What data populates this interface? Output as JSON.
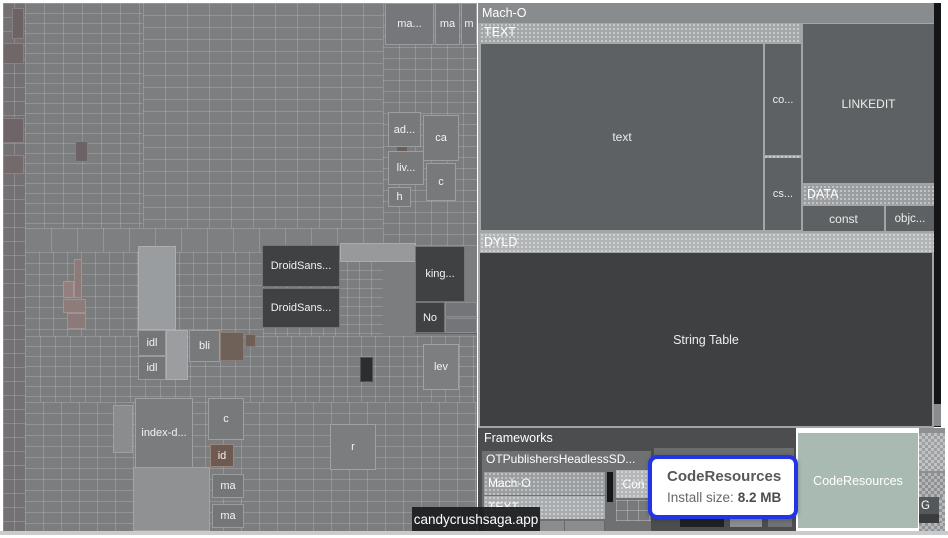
{
  "macho": {
    "title": "Mach-O",
    "text_header": "TEXT",
    "text_block": "text",
    "co_block": "co...",
    "cs_block": "cs...",
    "linkedit": "LINKEDIT",
    "data_header": "DATA",
    "const_block": "const",
    "objc_block": "objc...",
    "dyld_header": "DYLD",
    "string_table": "String Table"
  },
  "frameworks": {
    "title": "Frameworks",
    "ot_title": "OTPublishersHeadlessSD...",
    "ot_macho": "Mach-O",
    "ot_text": "TEXT",
    "con": "Con"
  },
  "code_resources_block": "CodeResources",
  "g_block": "G",
  "tooltips": {
    "selection": {
      "title": "CodeResources",
      "label": "Install size:",
      "value": "8.2 MB"
    },
    "hover": "candycrushsaga.app"
  },
  "colors": {
    "accent_blue": "#2334e6",
    "code_resources_green": "#a9bab2",
    "string_table_dark": "#3e4042"
  },
  "left_map_cells": [
    {
      "label": "ma...",
      "x": 382,
      "y": 0,
      "w": 49,
      "h": 42,
      "bg": "#75777a"
    },
    {
      "label": "ma",
      "x": 432,
      "y": 0,
      "w": 25,
      "h": 42,
      "bg": "#75777a"
    },
    {
      "label": "m",
      "x": 458,
      "y": 0,
      "w": 16,
      "h": 42,
      "bg": "#75777a"
    },
    {
      "label": "ad...",
      "x": 385,
      "y": 109,
      "w": 33,
      "h": 35,
      "bg": "#77797b"
    },
    {
      "label": "ca",
      "x": 420,
      "y": 112,
      "w": 36,
      "h": 46,
      "bg": "#77797b"
    },
    {
      "label": "liv...",
      "x": 385,
      "y": 148,
      "w": 36,
      "h": 34,
      "bg": "#77797b"
    },
    {
      "label": "c",
      "x": 423,
      "y": 160,
      "w": 30,
      "h": 38,
      "bg": "#77797b"
    },
    {
      "label": "h",
      "x": 385,
      "y": 184,
      "w": 23,
      "h": 20,
      "bg": "#77797b"
    },
    {
      "label": "DroidSans...",
      "x": 259,
      "y": 242,
      "w": 78,
      "h": 42,
      "bg": "#3f4143"
    },
    {
      "label": "DroidSans...",
      "x": 259,
      "y": 285,
      "w": 78,
      "h": 40,
      "bg": "#3f4143"
    },
    {
      "label": "king...",
      "x": 412,
      "y": 243,
      "w": 50,
      "h": 56,
      "bg": "#3f4143"
    },
    {
      "label": "No",
      "x": 412,
      "y": 299,
      "w": 30,
      "h": 31,
      "bg": "#3f4143"
    },
    {
      "label": "idl",
      "x": 135,
      "y": 327,
      "w": 28,
      "h": 26,
      "bg": "#747678"
    },
    {
      "label": "idl",
      "x": 135,
      "y": 353,
      "w": 28,
      "h": 24,
      "bg": "#747678"
    },
    {
      "label": "bli",
      "x": 186,
      "y": 327,
      "w": 31,
      "h": 32,
      "bg": "#77797b"
    },
    {
      "label": "lev",
      "x": 420,
      "y": 341,
      "w": 36,
      "h": 46,
      "bg": "#7c7e80"
    },
    {
      "label": "index-d...",
      "x": 132,
      "y": 395,
      "w": 58,
      "h": 70,
      "bg": "#7a7c7e"
    },
    {
      "label": "c",
      "x": 205,
      "y": 395,
      "w": 36,
      "h": 42,
      "bg": "#77797b"
    },
    {
      "label": "id",
      "x": 207,
      "y": 441,
      "w": 24,
      "h": 23,
      "bg": "#6e5a50"
    },
    {
      "label": "ma",
      "x": 209,
      "y": 471,
      "w": 32,
      "h": 24,
      "bg": "#747678"
    },
    {
      "label": "ma",
      "x": 209,
      "y": 501,
      "w": 32,
      "h": 24,
      "bg": "#747678"
    },
    {
      "label": "r",
      "x": 327,
      "y": 421,
      "w": 46,
      "h": 46,
      "bg": "#7b7d7f"
    }
  ]
}
